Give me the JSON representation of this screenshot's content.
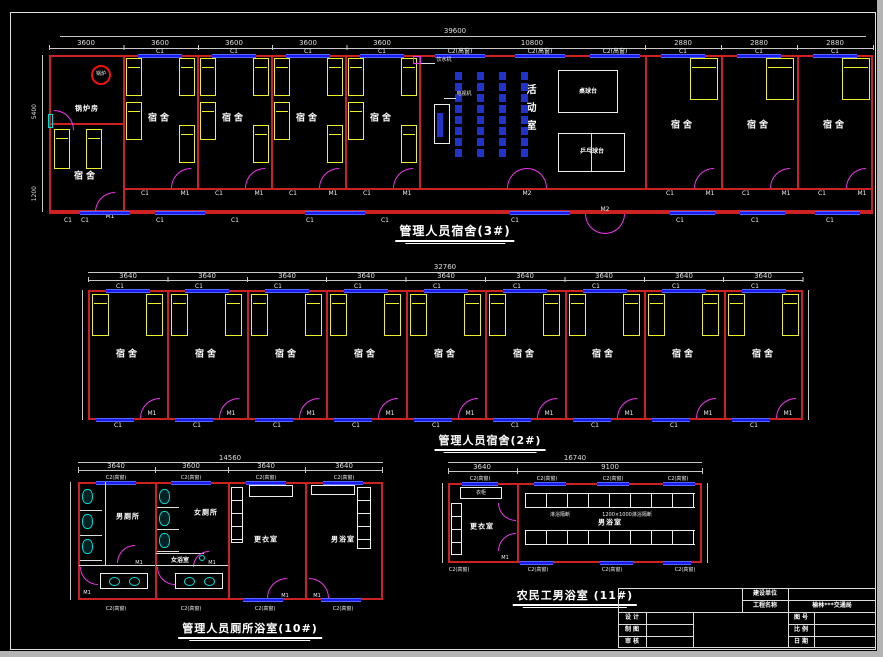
{
  "sheet": {
    "bg": "#000000",
    "frame": "#e0e0e0",
    "chrome": "#b4b4b4"
  },
  "colors": {
    "wall": "#cc2222",
    "window": "#1a1aee",
    "bed": "#eeee33",
    "door": "#ee33ee",
    "fixture": "#00dddd",
    "dim_text": "#dddddd",
    "boiler": "#ee1111"
  },
  "labels": {
    "dorm": "宿舍",
    "c1": "C1",
    "m1": "M1",
    "m2": "M2",
    "c2h": "C2(高窗)"
  },
  "plan1": {
    "title": "管理人员宿舍(3#)",
    "overall": "39600",
    "dims": [
      "3600",
      "3600",
      "3600",
      "3600",
      "3600",
      "10800",
      "2880",
      "2880",
      "2880"
    ],
    "side_dims": [
      "5400",
      "1200"
    ],
    "boiler_room": "锅炉房",
    "boiler": "锅炉",
    "activity": "活动室",
    "billiard": "桌球台",
    "pingpong": "乒乓球台",
    "water": "饮水机",
    "tv": "电视机"
  },
  "plan2": {
    "title": "管理人员宿舍(2#)",
    "overall": "32760",
    "bay": "3640"
  },
  "plan3": {
    "title": "管理人员厕所浴室(10#)",
    "overall": "14560",
    "dims": [
      "3640",
      "3600",
      "3640",
      "3640"
    ],
    "mens_toilet": "男厕所",
    "womens_toilet": "女厕所",
    "womens_bath": "女浴室",
    "changing": "更衣室",
    "mens_bath": "男浴室"
  },
  "plan4": {
    "title": "农民工男浴室 (11#)",
    "overall": "16740",
    "dims": [
      "3640",
      "9100"
    ],
    "changing": "更衣室",
    "mens_bath": "男浴室",
    "wardrobe": "衣柜",
    "shower1": "淋浴隔断",
    "shower2": "1200×1000淋浴隔断"
  },
  "titleblock": {
    "owner": "建设单位",
    "project": "工程名称",
    "project_value": "榆林***交通局",
    "design": "设 计",
    "draft": "制 图",
    "check": "审 核",
    "figno": "图 号",
    "scale": "比 例",
    "date": "日 期"
  }
}
